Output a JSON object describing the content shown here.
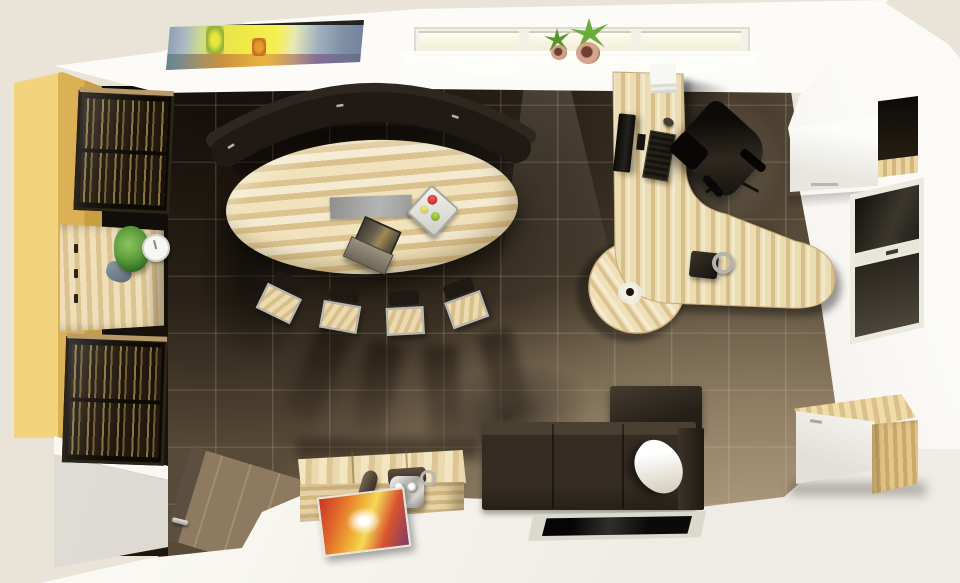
{
  "scene": {
    "title": "Top-down 3D render of an executive office interior",
    "view": "orthographic top view, afternoon light from top windows",
    "palette": {
      "outer_wall": "#e9e4d7",
      "inner_wall_white": "#f4f2ec",
      "floor_dark_tile": "#2a2218",
      "floor_light_tile": "#a4937a",
      "tile_grout": "#d5c9af",
      "wood_light": "#ecdcb2",
      "wood_stripe": "#d8be8a",
      "yellow_panel": "#e5c066",
      "dark_upholstery": "#241f17",
      "sofa_brown": "#352d23",
      "white_floor": "#f2f0e9",
      "painting_yellow": "#f1ea45",
      "painting_blue": "#8a97ae",
      "chrome": "#c9c7c2",
      "plant_green": "#6aab3a",
      "terracotta": "#c08a77",
      "fruit_red": "#cc2a33",
      "fruit_green": "#8cba2e",
      "glass_black": "#0a0a08"
    },
    "labels": {
      "room": "open-plan executive office, top-down render",
      "floor_tiles": "dark brown ceramic tile floor fading to tan in sunlight",
      "white_platform": "raised white floor platform along the bottom",
      "painting": "abstract landscape painting on top wall",
      "top_windows": "three-pane window band on top wall",
      "sill_plants": "two potted succulents on windowsill",
      "wardrobe_panel": "tall yellow wood wardrobe panel, left wall",
      "bookcase_upper": "dark glass-front bookcase with books, upper left",
      "bookcase_lower": "dark glass-front bookcase with books, lower left",
      "console": "striped wood console desk with drawers",
      "console_plant": "green potted plant on console",
      "clock": "small white desk clock",
      "conference_table": "oval striped-wood conference table",
      "table_inlay": "gray rectangular center inlay",
      "laptop": "open laptop on conference table",
      "fruit_tray": "square tray with fruit",
      "curved_bench": "curved dark upholstered bench along table top side",
      "guest_chairs": "four wooden-seat guest chairs, fanned below table",
      "chair_shadows": "long cast shadows of guest chairs",
      "workstation_desk": "J-shaped striped-wood workstation desk",
      "round_table": "round striped-wood extension table",
      "coffee_cup": "espresso cup on round table",
      "monitor": "flat monitor on desk",
      "keyboard": "dark keyboard",
      "mouse": "computer mouse",
      "papers": "stack of white paper",
      "desk_phone": "dark desk phone with chrome handset",
      "office_chair": "black executive swivel chair",
      "sofa": "dark brown modular sofa with corner return",
      "pillow": "white throw pillow",
      "coffee_table_inset": "black glass coffee table inset in white floor",
      "chest_table": "light wood chest coffee table",
      "roller": "wooden roller stamp",
      "grinder": "chrome vintage grinder",
      "magazine": "colorful magazine on white floor",
      "hanging_cabinet": "white wall-hung cabinet with open dark bay, upper right",
      "right_window": "tall window on right wall",
      "sideboard": "white and wood sideboard, lower right",
      "doormat": "tan tiled entry mat, lower left",
      "door_handle": "chrome floor-level door handle",
      "partition": "low white partition wall, lower left"
    }
  }
}
